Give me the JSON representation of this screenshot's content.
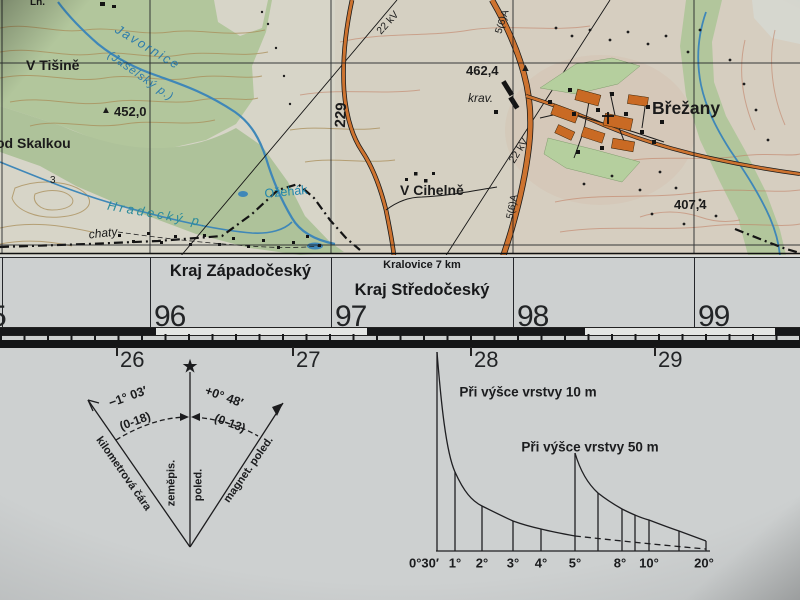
{
  "map": {
    "labels": {
      "lh": "Lh.",
      "v_tisine": "V Tišině",
      "javornice": "Javornice",
      "jaselsky": "(Jaselský p.)",
      "spot_452": "452,0",
      "pod_skalkou": "od Skalkou",
      "spot_3": "3",
      "hradecky": "Hradecký p.",
      "chaty": "chaty",
      "ozehak": "Ožehák",
      "v_cihelne": "V Cihelně",
      "road_229": "229",
      "kv_22_a": "22 kV",
      "kv_22_b": "22 kV",
      "road_5_6_a_top": "5(6)A",
      "road_5_6_a": "5(6)A",
      "spot_462": "462,4",
      "krav": "krav.",
      "brezany": "Břežany",
      "spot_407": "407,4"
    },
    "colors": {
      "forest": "#b2c69c",
      "water": "#3f87b8",
      "road_fill": "#cd7330",
      "contour": "#b08a52",
      "paper": "#d7d5c8"
    }
  },
  "margin": {
    "kraj_west": "Kraj Západočeský",
    "kralovice_distance": "Kralovice 7 km",
    "kraj_central": "Kraj Středočeský",
    "grid_top": [
      "5",
      "96",
      "97",
      "98",
      "99"
    ],
    "grid_bottom": [
      "26",
      "27",
      "28",
      "29"
    ]
  },
  "declination": {
    "left_angle": "−1° 03′",
    "left_mils": "(0-18)",
    "right_angle": "+0° 48′",
    "right_mils": "(0-13)",
    "left_line_label": "kilometrová čára",
    "center_line_label_1": "zeměpis.",
    "center_line_label_2": "poled.",
    "right_line_label": "magnet. poled."
  },
  "slope_scale": {
    "title_10m": "Při výšce vrstvy 10 m",
    "title_50m": "Při výšce vrstvy 50 m",
    "tick_labels": [
      "0°30′",
      "1°",
      "2°",
      "3°",
      "4°",
      "5°",
      "8°",
      "10°",
      "20°"
    ]
  }
}
